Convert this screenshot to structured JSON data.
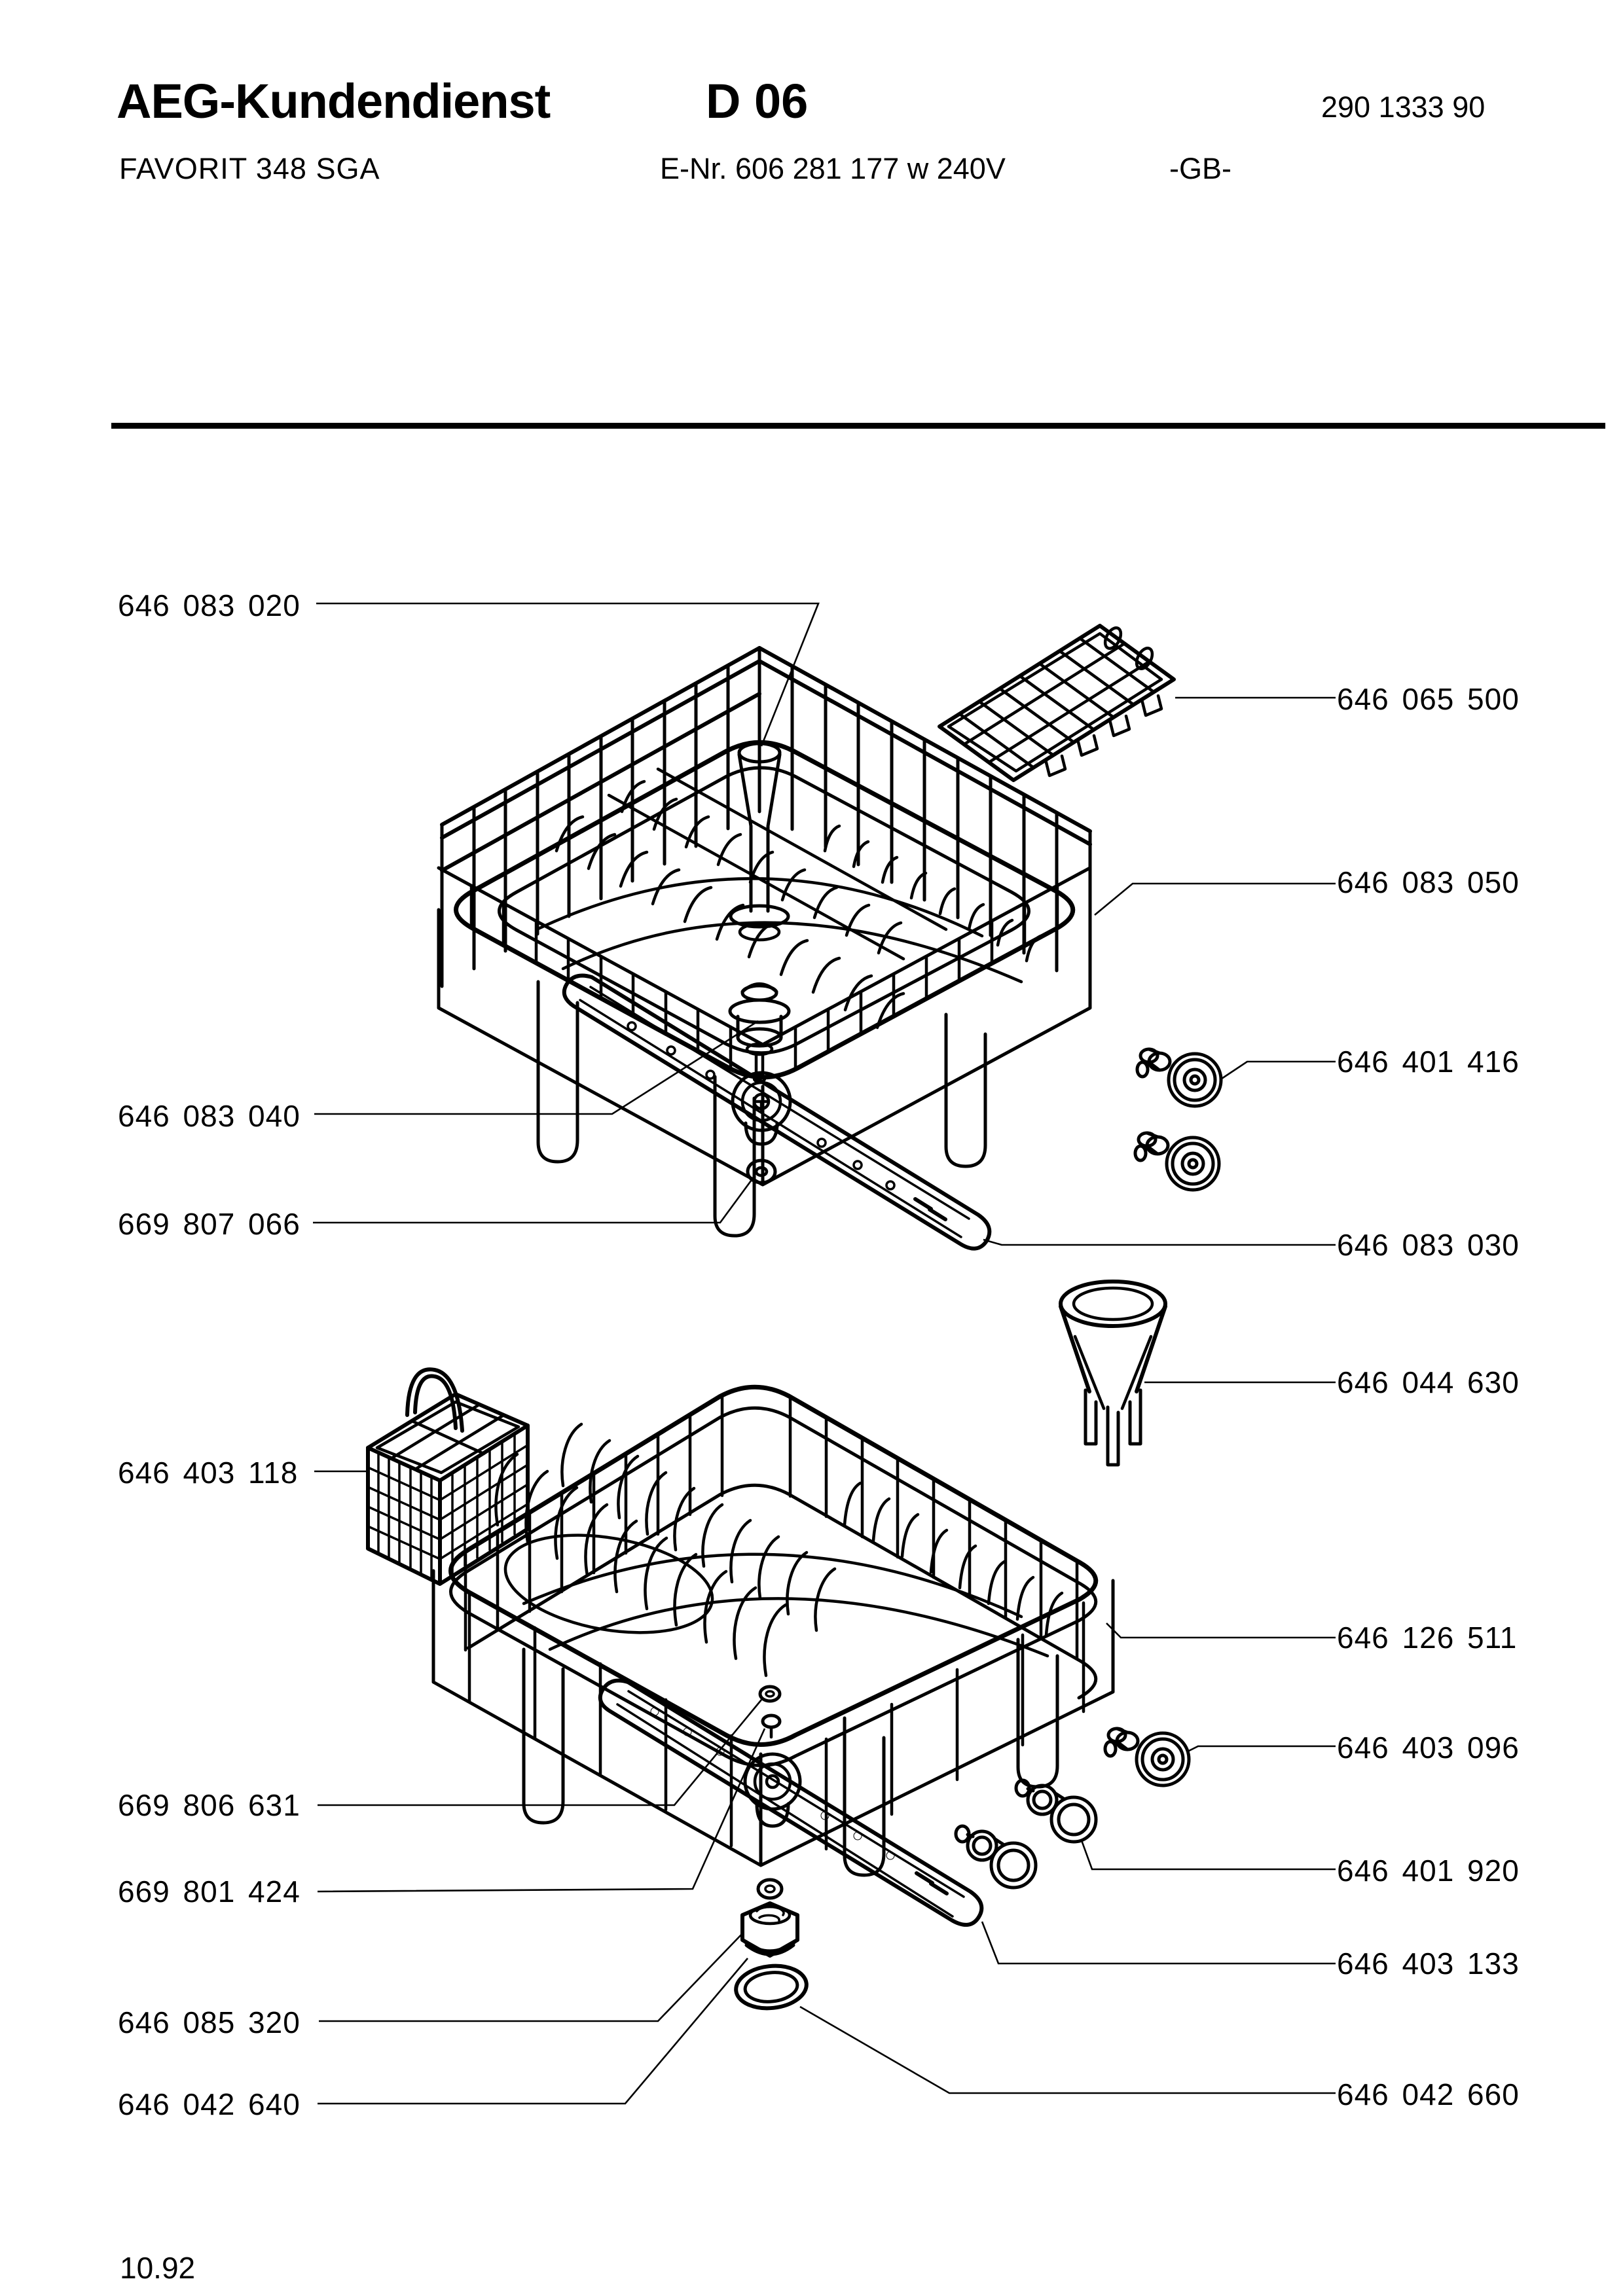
{
  "header": {
    "brand": "AEG-Kundendienst",
    "sheet_code": "D 06",
    "doc_number": "290 1333 90",
    "model": "FAVORIT 348 SGA",
    "e_nr_line": "E-Nr.  606 281 177  w  240V",
    "market": "-GB-"
  },
  "footer": {
    "date": "10.92"
  },
  "parts_left": [
    {
      "number": "646 083 020"
    },
    {
      "number": "646 083 040"
    },
    {
      "number": "669 807 066"
    },
    {
      "number": "646 403 118"
    },
    {
      "number": "669 806 631"
    },
    {
      "number": "669 801 424"
    },
    {
      "number": "646 085 320"
    },
    {
      "number": "646 042 640"
    }
  ],
  "parts_right": [
    {
      "number": "646 065 500"
    },
    {
      "number": "646 083 050"
    },
    {
      "number": "646 401 416"
    },
    {
      "number": "646 083 030"
    },
    {
      "number": "646 044 630"
    },
    {
      "number": "646 126 511"
    },
    {
      "number": "646 403 096"
    },
    {
      "number": "646 401 920"
    },
    {
      "number": "646 403 133"
    },
    {
      "number": "646 042 660"
    }
  ]
}
